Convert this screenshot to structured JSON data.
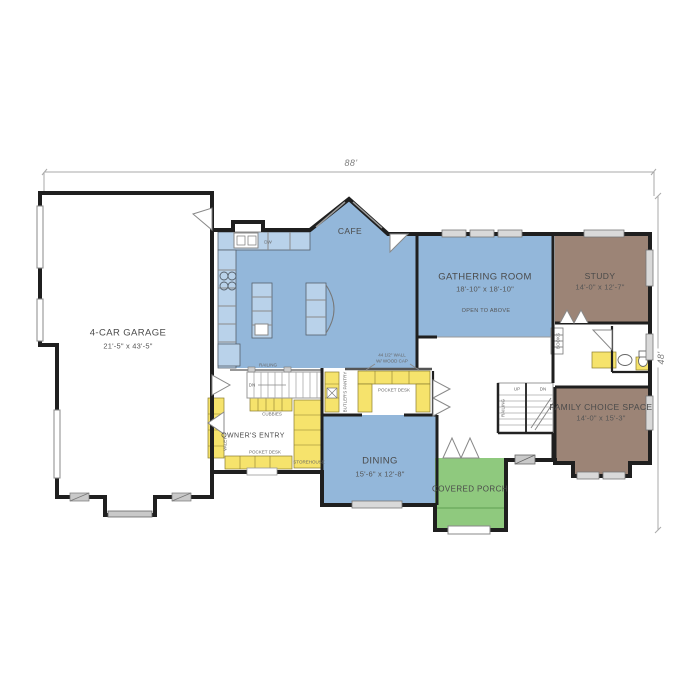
{
  "colors": {
    "room_blue": "#93b7da",
    "room_brown": "#9c8476",
    "porch_green": "#8fc97e",
    "cabinet_yellow": "#f6e36c",
    "wall_black": "#1f1f1f"
  },
  "dimensions": {
    "overall_width": "88'",
    "overall_depth": "48'"
  },
  "rooms": {
    "garage": {
      "name": "4-CAR GARAGE",
      "size": "21'-5\" x 43'-5\""
    },
    "cafe": {
      "name": "CAFE"
    },
    "gathering": {
      "name": "GATHERING ROOM",
      "size": "18'-10\" x 18'-10\"",
      "note": "OPEN TO ABOVE"
    },
    "study": {
      "name": "STUDY",
      "size": "14'-0\" x 12'-7\""
    },
    "family": {
      "name": "FAMILY CHOICE SPACE",
      "size": "14'-0\" x 15'-3\""
    },
    "dining": {
      "name": "DINING",
      "size": "15'-6\" x 12'-8\""
    },
    "porch": {
      "name": "COVERED PORCH"
    },
    "owners_entry": {
      "name": "OWNER'S ENTRY"
    }
  },
  "annotations": {
    "railing_entry": "RAILING",
    "dn_entry": "DN",
    "cubbies": "CUBBIES",
    "pocket_desk_entry": "POCKET DESK",
    "storehouse": "STOREHOUSE",
    "valet": "VALET",
    "butlers_pantry": "BUTLER'S PANTRY",
    "half_wall_line1": "44 1/2\" WALL",
    "half_wall_line2": "W/ WOOD CAP",
    "pocket_desk_butler": "POCKET DESK",
    "up": "UP",
    "dn_stairs": "DN",
    "railing_stairs": "RAILING",
    "books": "BOOKS",
    "dw": "DW"
  }
}
